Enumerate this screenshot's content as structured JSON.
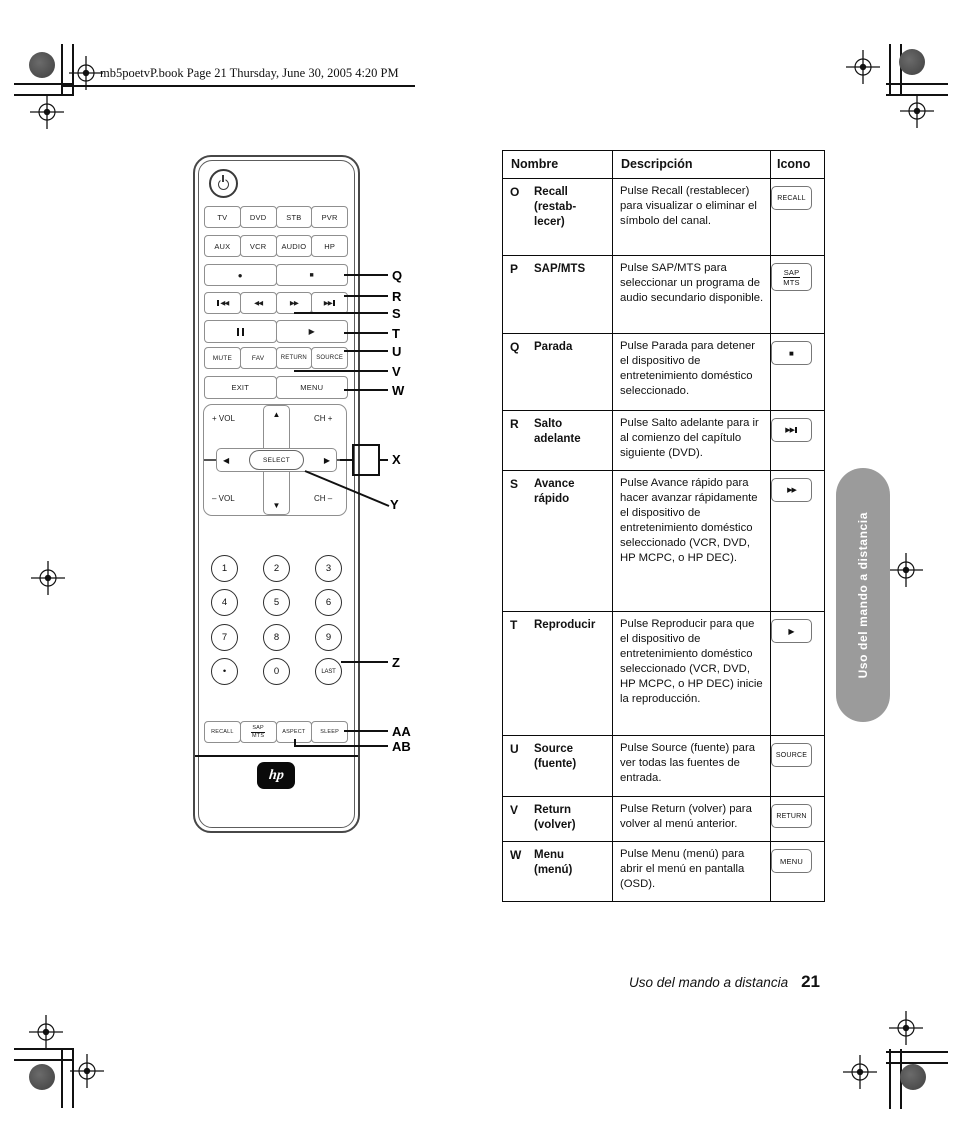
{
  "page": {
    "header_text": "mb5poetvP.book  Page 21  Thursday, June 30, 2005  4:20 PM",
    "side_tab": "Uso del mando a distancia",
    "footer_label": "Uso del mando a distancia",
    "footer_page": "21"
  },
  "remote": {
    "devices1": [
      "TV",
      "DVD",
      "STB",
      "PVR"
    ],
    "devices2": [
      "AUX",
      "VCR",
      "AUDIO",
      "HP"
    ],
    "record": "●",
    "stop": "■",
    "rewind": "◀◀",
    "forward": "▶▶",
    "play": "▶",
    "row_functions": [
      "MUTE",
      "FAV",
      "RETURN",
      "SOURCE"
    ],
    "row_menu": [
      "EXIT",
      "MENU"
    ],
    "dpad": {
      "vol_up": "+ VOL",
      "ch_up": "CH +",
      "vol_down": "– VOL",
      "ch_down": "CH –",
      "up": "▲",
      "down": "▼",
      "left": "◀",
      "right": "▶",
      "select": "SELECT"
    },
    "keys": [
      "1",
      "2",
      "3",
      "4",
      "5",
      "6",
      "7",
      "8",
      "9",
      "•",
      "0",
      "LAST"
    ],
    "bottom": {
      "recall": "RECALL",
      "sap": "SAP",
      "mts": "MTS",
      "aspect": "ASPECT",
      "sleep": "SLEEP"
    },
    "logo": "hp"
  },
  "callouts": {
    "q": "Q",
    "r": "R",
    "s": "S",
    "t": "T",
    "u": "U",
    "v": "V",
    "w": "W",
    "x": "X",
    "y": "Y",
    "z": "Z",
    "aa": "AA",
    "ab": "AB"
  },
  "table": {
    "headers": [
      "Nombre",
      "Descripción",
      "Icono"
    ],
    "rows": [
      {
        "letter": "O",
        "name": "Recall\n(restab-\nlecer)",
        "desc": "Pulse Recall (restablecer) para visualizar o eliminar el símbolo del canal.",
        "icon_text": "RECALL"
      },
      {
        "letter": "P",
        "name": "SAP/MTS",
        "desc": "Pulse SAP/MTS para seleccionar un programa de audio secundario disponible.",
        "icon_top": "SAP",
        "icon_bottom": "MTS"
      },
      {
        "letter": "Q",
        "name": "Parada",
        "desc": "Pulse Parada para detener el dispositivo de entretenimiento doméstico seleccionado.",
        "icon_glyph": "■"
      },
      {
        "letter": "R",
        "name": "Salto\nadelante",
        "desc": "Pulse Salto adelante para ir al comienzo del capítulo siguiente (DVD).",
        "icon_glyph": "▶▶"
      },
      {
        "letter": "S",
        "name": "Avance\nrápido",
        "desc": "Pulse Avance rápido para hacer avanzar rápidamente el dispositivo de entretenimiento doméstico seleccionado (VCR, DVD, HP MCPC, o HP DEC).",
        "icon_glyph": "▶▶"
      },
      {
        "letter": "T",
        "name": "Reproducir",
        "desc": "Pulse Reproducir para que el dispositivo de entretenimiento doméstico seleccionado (VCR, DVD, HP MCPC, o HP DEC) inicie la reproducción.",
        "icon_glyph": "▶"
      },
      {
        "letter": "U",
        "name": "Source\n(fuente)",
        "desc": "Pulse Source (fuente) para ver todas las fuentes de entrada.",
        "icon_text": "SOURCE"
      },
      {
        "letter": "V",
        "name": "Return\n(volver)",
        "desc": "Pulse Return (volver) para volver al menú anterior.",
        "icon_text": "RETURN"
      },
      {
        "letter": "W",
        "name": "Menu\n(menú)",
        "desc": "Pulse Menu (menú) para abrir el menú en pantalla (OSD).",
        "icon_text": "MENU"
      }
    ]
  }
}
